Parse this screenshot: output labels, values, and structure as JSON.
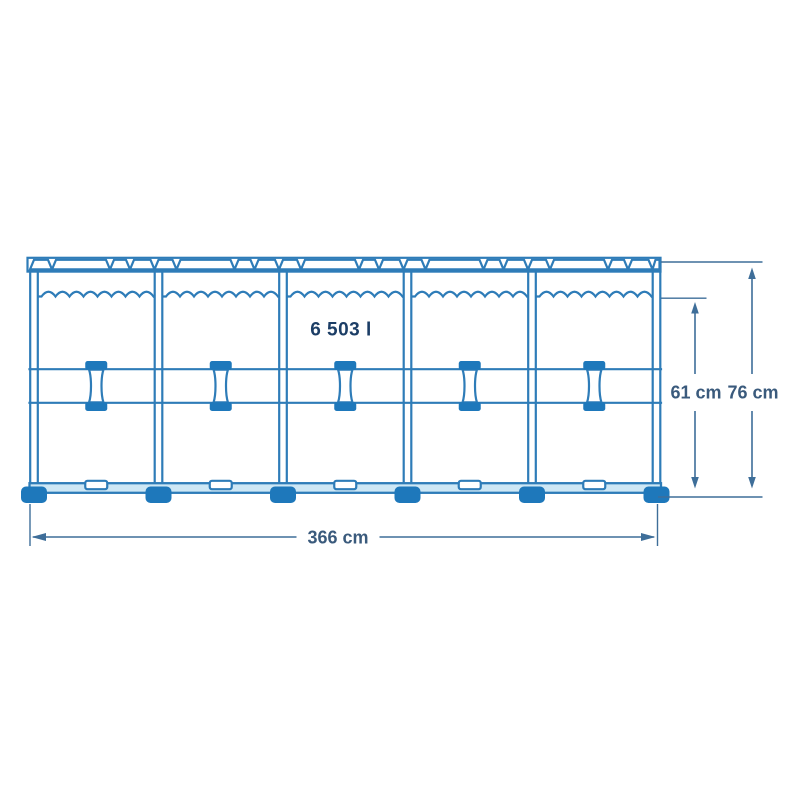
{
  "diagram": {
    "type": "above-ground-frame-pool-side-view",
    "capacity_label": "6 503 l",
    "capacity_value_l": 6503,
    "dimensions": {
      "width": {
        "label": "366 cm",
        "value_cm": 366
      },
      "water_height": {
        "label": "61 cm",
        "value_cm": 61
      },
      "total_height": {
        "label": "76 cm",
        "value_cm": 76
      }
    },
    "structure": {
      "bays": 5,
      "posts": 6,
      "t_joints": 5,
      "feet": 6
    },
    "colors": {
      "line": "#2e7cb8",
      "solid": "#1e78bb",
      "rail-fill": "#cde7f5",
      "dim-line": "#3e6e99",
      "dim-text": "#3a5a7c",
      "navy-text": "#1c3e66",
      "background": "#ffffff"
    }
  }
}
